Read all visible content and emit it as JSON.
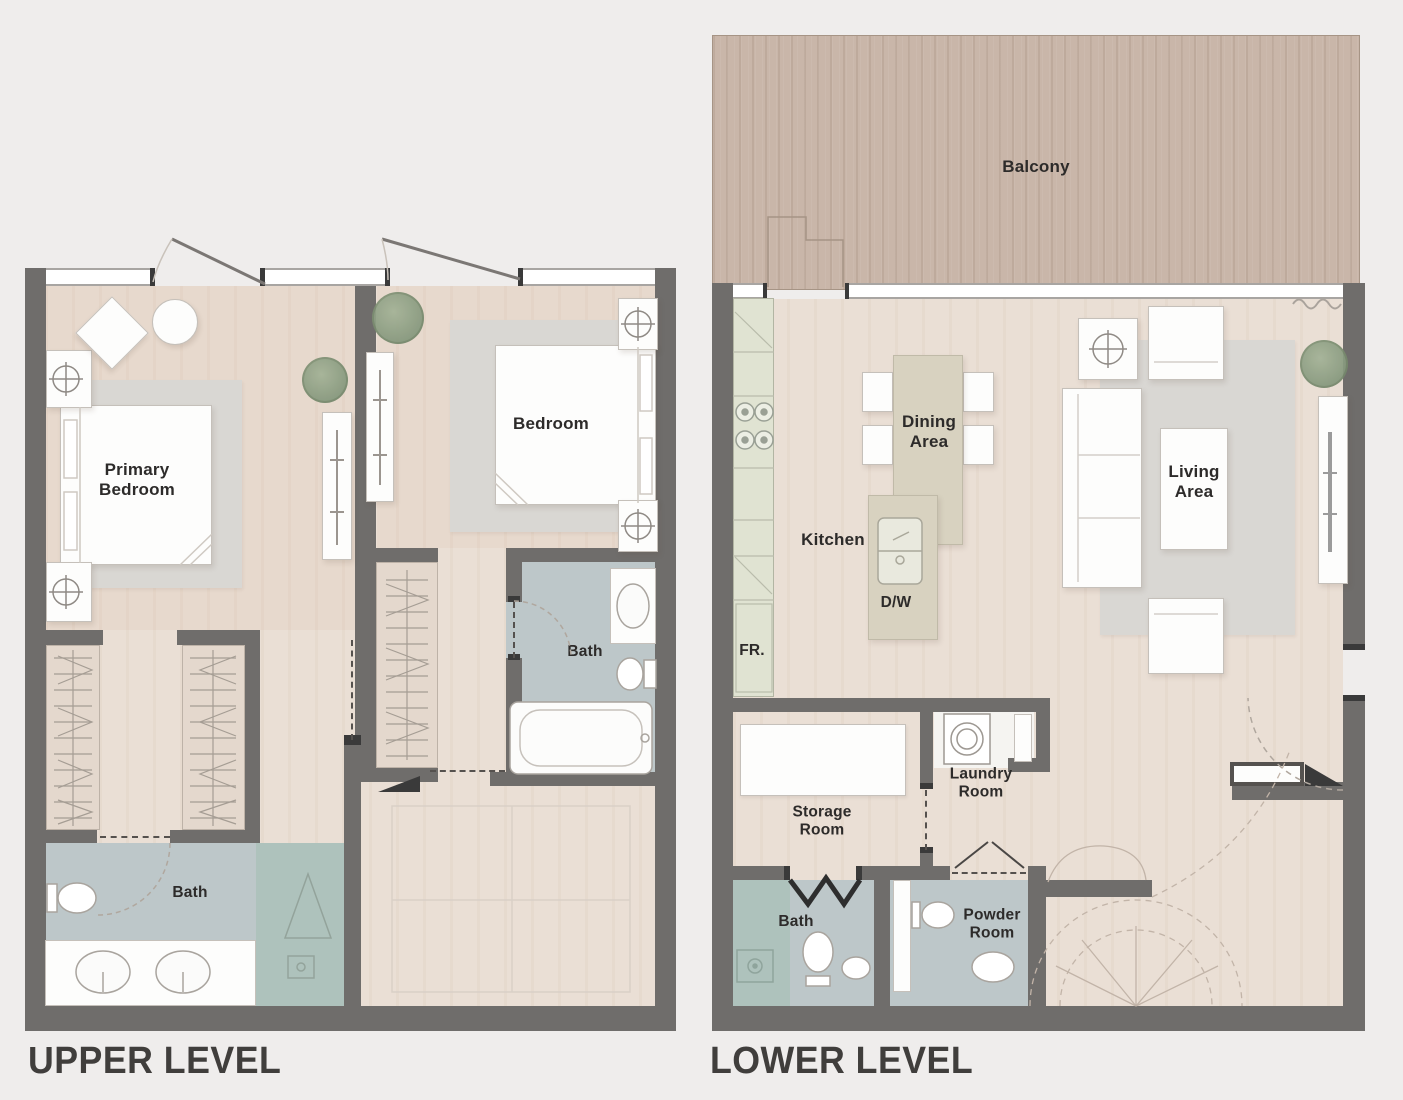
{
  "page": {
    "upper_title": "UPPER LEVEL",
    "lower_title": "LOWER LEVEL"
  },
  "upper": {
    "labels": {
      "primary_bedroom": "Primary\nBedroom",
      "bedroom": "Bedroom",
      "bath_ensuite": "Bath",
      "bath_main": "Bath"
    }
  },
  "lower": {
    "labels": {
      "balcony": "Balcony",
      "dining": "Dining\nArea",
      "kitchen": "Kitchen",
      "dishwasher": "D/W",
      "fridge": "FR.",
      "living": "Living\nArea",
      "storage": "Storage\nRoom",
      "laundry": "Laundry\nRoom",
      "bath": "Bath",
      "powder": "Powder\nRoom"
    }
  },
  "icons": {
    "toilet-icon": "svg-ellipse",
    "sink-icon": "svg-ellipse",
    "bathtub-icon": "svg-rounded-rect",
    "shower-icon": "svg-triangle",
    "stove-icon": "svg-circles",
    "washer-icon": "svg-circle-in-square",
    "lamp-icon": "svg-circle-cross",
    "plant-icon": "css-radial-circle",
    "wardrobe-hanger-icon": "svg-zigzag",
    "stair-icon": "svg-dashed-arcs",
    "door-swing-icon": "svg-diagonal-line",
    "tv-icon": "svg-line"
  },
  "colors": {
    "bg": "#efedec",
    "wall": "#6f6d6b",
    "wallDark": "#3a3a3a",
    "floor": "#eadfd5",
    "floorDeep": "#e4d8cd",
    "bath": "#bdc7c9",
    "shower": "#aec2bc",
    "balcony": "#c9b6a9",
    "balconyLine": "#a69485",
    "counter": "#e0e3d2",
    "counterLine": "#b2b5a3",
    "table": "#d8d2c0",
    "rug": "#d9d7d3",
    "white": "#fdfdfc",
    "furline": "#c5c0ba",
    "line": "#a19b94",
    "lite": "#c3b9ae",
    "label": "#2d2b2a",
    "title": "#403e3c",
    "plant1": "#a3b296",
    "plant2": "#82957a"
  }
}
